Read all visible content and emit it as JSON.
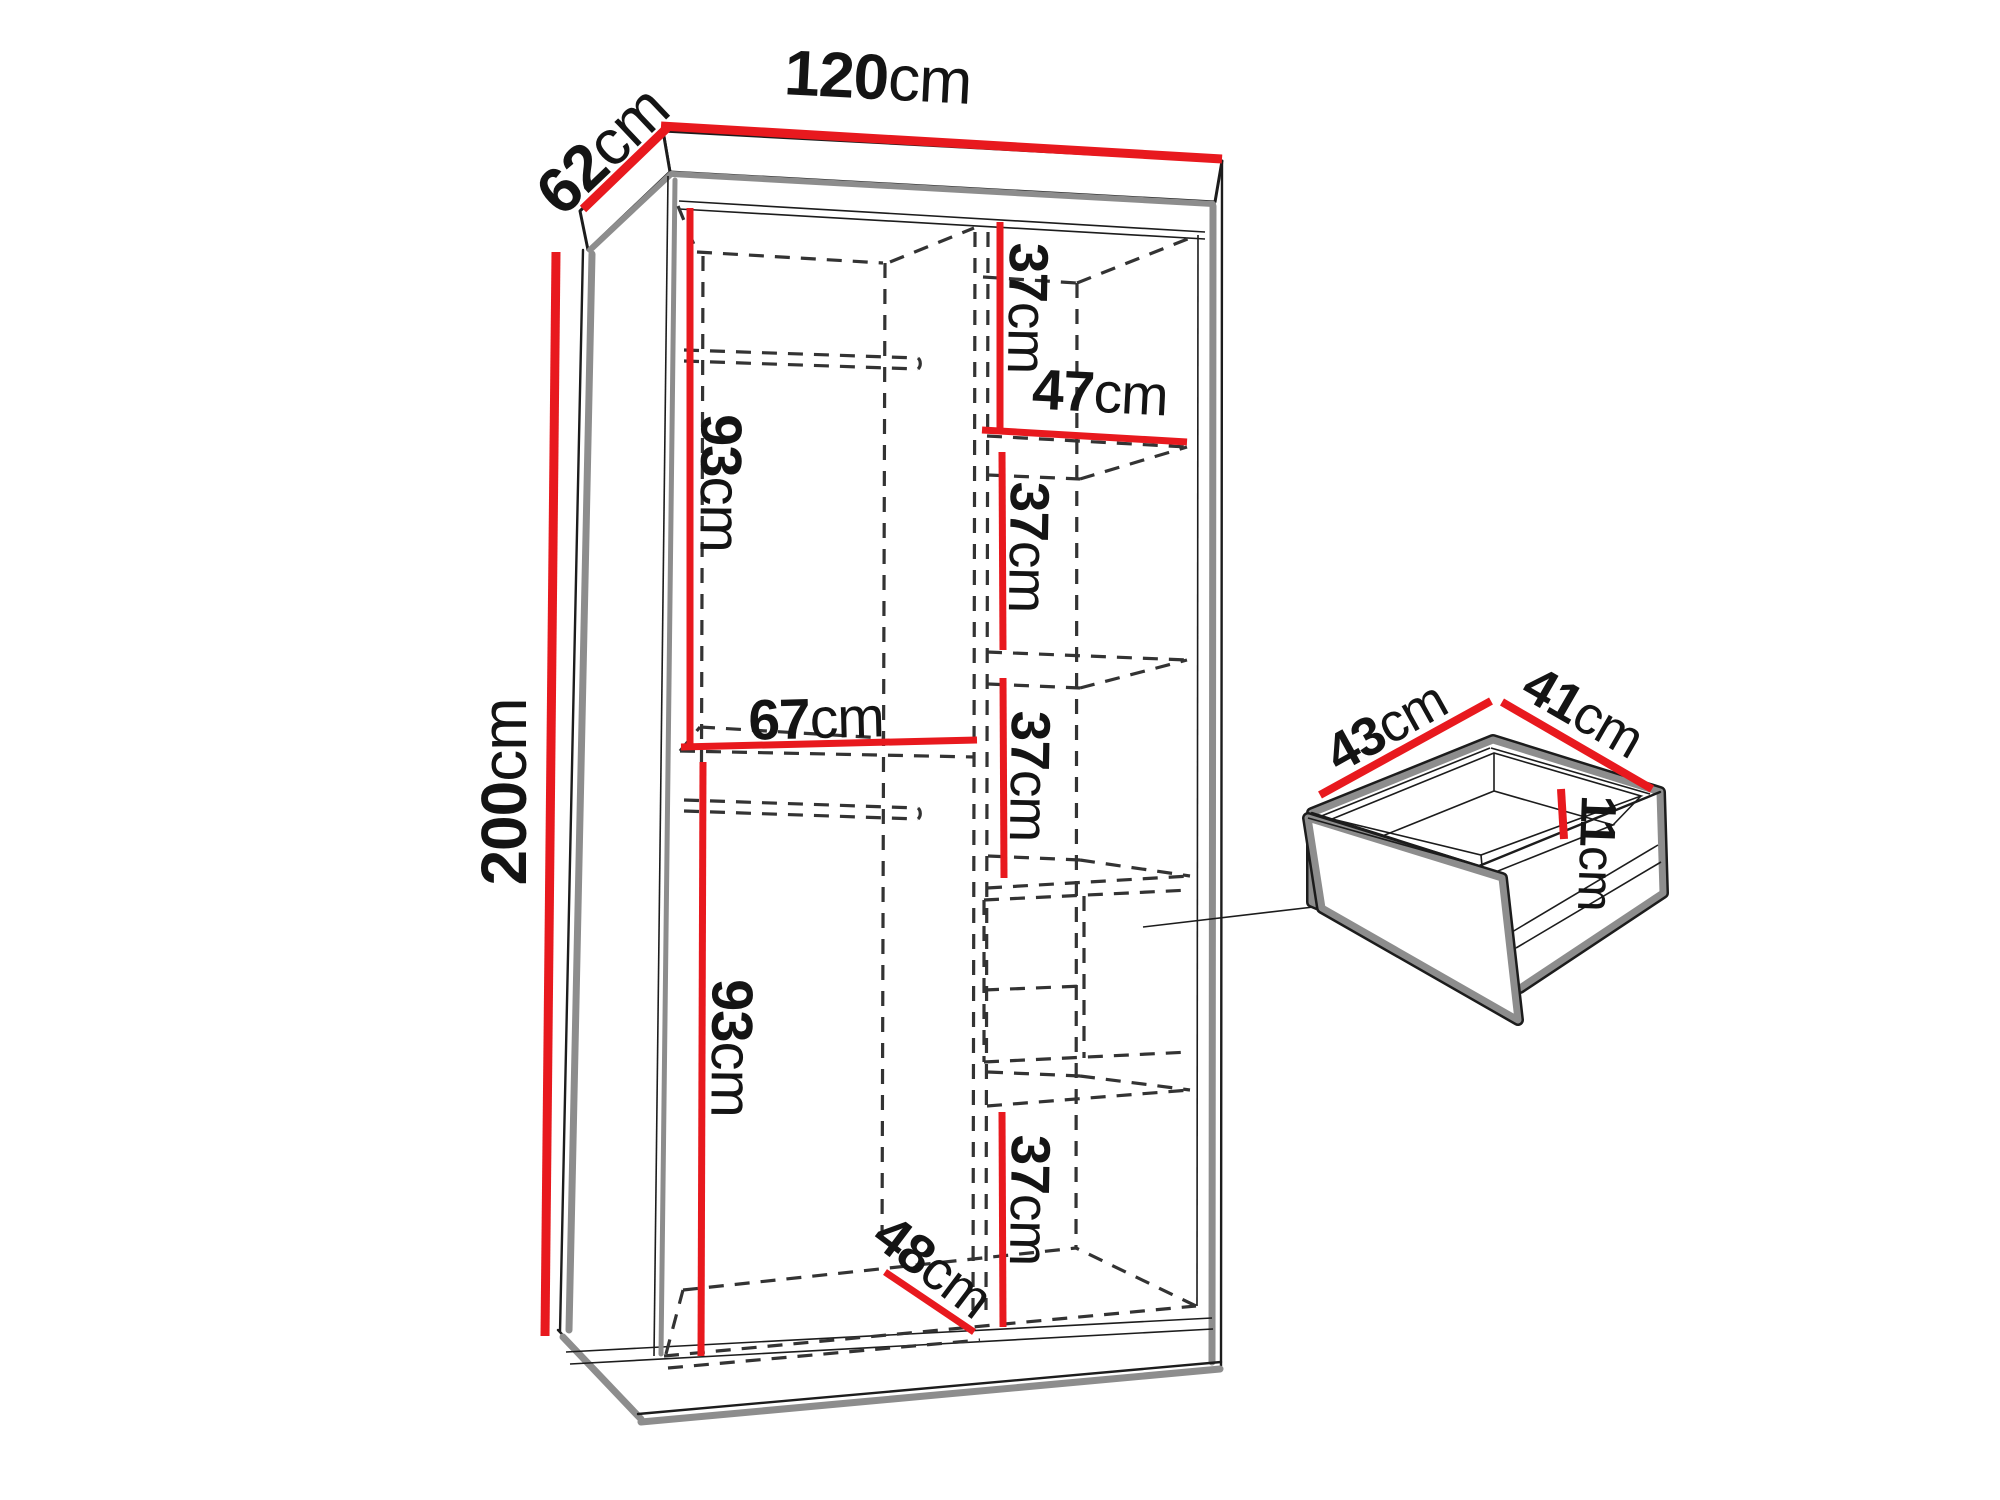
{
  "diagram_type": "furniture-dimension-drawing",
  "unit": "cm",
  "colors": {
    "dim_red": "#e8191e",
    "line_black": "#1c1c1c",
    "shadow_gray": "#8d8d8d",
    "dash_color": "#333333",
    "background": "#ffffff",
    "text_color": "#141414"
  },
  "wardrobe": {
    "labels": {
      "width": {
        "value": "120",
        "unit": "cm"
      },
      "depth": {
        "value": "62",
        "unit": "cm"
      },
      "height": {
        "value": "200",
        "unit": "cm"
      },
      "upper_left_section_height": {
        "value": "93",
        "unit": "cm"
      },
      "left_shelf_width": {
        "value": "67",
        "unit": "cm"
      },
      "lower_left_section_height": {
        "value": "93",
        "unit": "cm"
      },
      "interior_depth": {
        "value": "48",
        "unit": "cm"
      },
      "shelf_gap_1": {
        "value": "37",
        "unit": "cm"
      },
      "shelf_width": {
        "value": "47",
        "unit": "cm"
      },
      "shelf_gap_2": {
        "value": "37",
        "unit": "cm"
      },
      "shelf_gap_3": {
        "value": "37",
        "unit": "cm"
      },
      "shelf_gap_4": {
        "value": "37",
        "unit": "cm"
      }
    }
  },
  "drawer": {
    "labels": {
      "width": {
        "value": "43",
        "unit": "cm"
      },
      "depth": {
        "value": "41",
        "unit": "cm"
      },
      "height": {
        "value": "11",
        "unit": "cm"
      }
    }
  }
}
